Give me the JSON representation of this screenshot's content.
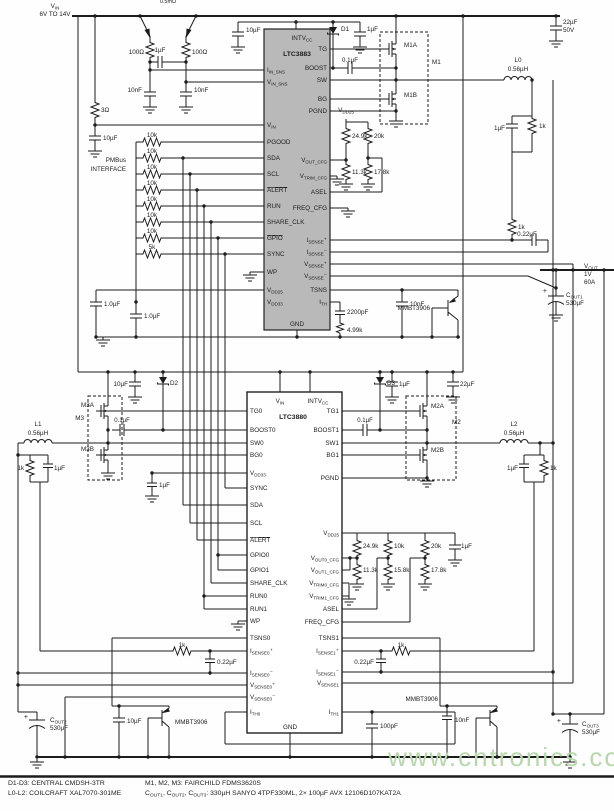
{
  "watermark": "www.cntronics.com",
  "colors": {
    "wire": "#1c1c1c",
    "ic_fill": "#b9b9b9",
    "ic_stroke": "#222222",
    "watermark": "#b7d8ab",
    "background": "#fefefe"
  },
  "labels": [
    {
      "t": "V~IN~",
      "x": 55,
      "y": 8,
      "a": "m",
      "n": "net-vin"
    },
    {
      "t": "6V TO 14V",
      "x": 55,
      "y": 16,
      "a": "m"
    },
    {
      "t": "0.5mΩ",
      "x": 168,
      "y": 3,
      "a": "m",
      "s": 5.5
    },
    {
      "t": "100Ω",
      "x": 144,
      "y": 54,
      "a": "e"
    },
    {
      "t": "100Ω",
      "x": 192,
      "y": 54
    },
    {
      "t": "1µF",
      "x": 160,
      "y": 52,
      "a": "m"
    },
    {
      "t": "10nF",
      "x": 142,
      "y": 92,
      "a": "e"
    },
    {
      "t": "10nF",
      "x": 194,
      "y": 92
    },
    {
      "t": "3Ω",
      "x": 101,
      "y": 112
    },
    {
      "t": "10µF",
      "x": 103,
      "y": 140
    },
    {
      "t": "10µF",
      "x": 246,
      "y": 32
    },
    {
      "t": "D1",
      "x": 341,
      "y": 31
    },
    {
      "t": "1µF",
      "x": 367,
      "y": 31
    },
    {
      "t": "22µF",
      "x": 563,
      "y": 24
    },
    {
      "t": "50V",
      "x": 563,
      "y": 32
    },
    {
      "t": "0.1µF",
      "x": 350,
      "y": 62,
      "a": "m"
    },
    {
      "t": "M1A",
      "x": 404,
      "y": 47
    },
    {
      "t": "M1B",
      "x": 404,
      "y": 97
    },
    {
      "t": "M1",
      "x": 432,
      "y": 64
    },
    {
      "t": "L0",
      "x": 518,
      "y": 62,
      "a": "m"
    },
    {
      "t": "0.56µH",
      "x": 518,
      "y": 71,
      "a": "m"
    },
    {
      "t": "1µF",
      "x": 505,
      "y": 130,
      "a": "e"
    },
    {
      "t": "1k",
      "x": 539,
      "y": 128
    },
    {
      "t": "1k",
      "x": 518,
      "y": 229
    },
    {
      "t": "0.22µF",
      "x": 527,
      "y": 236,
      "a": "m"
    },
    {
      "t": "V~OUT~",
      "x": 584,
      "y": 268,
      "n": "net-vout"
    },
    {
      "t": "1V",
      "x": 584,
      "y": 276
    },
    {
      "t": "60A",
      "x": 584,
      "y": 284
    },
    {
      "t": "+",
      "x": 547,
      "y": 293,
      "a": "e",
      "s": 7
    },
    {
      "t": "C~OUT1~",
      "x": 566,
      "y": 297
    },
    {
      "t": "530µF",
      "x": 566,
      "y": 305
    },
    {
      "t": "V~DD25~",
      "x": 346,
      "y": 112,
      "a": "m"
    },
    {
      "t": "24.9k",
      "x": 352,
      "y": 138
    },
    {
      "t": "20k",
      "x": 374,
      "y": 138
    },
    {
      "t": "11.3k",
      "x": 352,
      "y": 174
    },
    {
      "t": "17.8k",
      "x": 374,
      "y": 174
    },
    {
      "t": "PMBus",
      "x": 126,
      "y": 162,
      "a": "e"
    },
    {
      "t": "INTERFACE",
      "x": 126,
      "y": 171,
      "a": "e"
    },
    {
      "t": "10k",
      "x": 152,
      "y": 137,
      "a": "m"
    },
    {
      "t": "10k",
      "x": 152,
      "y": 153,
      "a": "m"
    },
    {
      "t": "10k",
      "x": 152,
      "y": 169,
      "a": "m"
    },
    {
      "t": "10k",
      "x": 152,
      "y": 185,
      "a": "m"
    },
    {
      "t": "10k",
      "x": 152,
      "y": 201,
      "a": "m"
    },
    {
      "t": "10k",
      "x": 152,
      "y": 217,
      "a": "m"
    },
    {
      "t": "10k",
      "x": 152,
      "y": 233,
      "a": "m"
    },
    {
      "t": "5k",
      "x": 152,
      "y": 249,
      "a": "m"
    },
    {
      "t": "1.0µF",
      "x": 104,
      "y": 306
    },
    {
      "t": "1.0µF",
      "x": 144,
      "y": 318
    },
    {
      "t": "2200pF",
      "x": 347,
      "y": 314
    },
    {
      "t": "4.99k",
      "x": 347,
      "y": 332
    },
    {
      "t": "10nF",
      "x": 410,
      "y": 306
    },
    {
      "t": "MMBT3906",
      "x": 430,
      "y": 310,
      "a": "e"
    },
    {
      "t": "I~IN_SNS~",
      "x": 267,
      "y": 72
    },
    {
      "t": "V~IN_SNS~",
      "x": 267,
      "y": 84
    },
    {
      "t": "V~IN~",
      "x": 267,
      "y": 127
    },
    {
      "t": "PGOOD",
      "x": 267,
      "y": 144
    },
    {
      "t": "SDA",
      "x": 267,
      "y": 160
    },
    {
      "t": "SCL",
      "x": 267,
      "y": 176
    },
    {
      "t": "ALERT",
      "x": 267,
      "y": 192,
      "o": 1
    },
    {
      "t": "RUN",
      "x": 267,
      "y": 208
    },
    {
      "t": "SHARE_CLK",
      "x": 267,
      "y": 224
    },
    {
      "t": "GPIO",
      "x": 267,
      "y": 240,
      "o": 1
    },
    {
      "t": "SYNC",
      "x": 267,
      "y": 256
    },
    {
      "t": "WP",
      "x": 267,
      "y": 274
    },
    {
      "t": "V~DD25~",
      "x": 267,
      "y": 292
    },
    {
      "t": "V~DD33~",
      "x": 267,
      "y": 304
    },
    {
      "t": "GND",
      "x": 297,
      "y": 326,
      "a": "m"
    },
    {
      "t": "INTV~CC~",
      "x": 302,
      "y": 40,
      "a": "m"
    },
    {
      "t": "LTC3883",
      "x": 297,
      "y": 56,
      "a": "m",
      "b": 1,
      "s": 6.8,
      "n": "ic-name"
    },
    {
      "t": "TG",
      "x": 327,
      "y": 51,
      "a": "e"
    },
    {
      "t": "BOOST",
      "x": 327,
      "y": 70,
      "a": "e"
    },
    {
      "t": "SW",
      "x": 327,
      "y": 82,
      "a": "e"
    },
    {
      "t": "BG",
      "x": 327,
      "y": 101,
      "a": "e"
    },
    {
      "t": "PGND",
      "x": 327,
      "y": 113,
      "a": "e"
    },
    {
      "t": "V~OUT_CFG~",
      "x": 327,
      "y": 162,
      "a": "e"
    },
    {
      "t": "V~TRIM_CFG~",
      "x": 327,
      "y": 178,
      "a": "e"
    },
    {
      "t": "ASEL",
      "x": 327,
      "y": 194,
      "a": "e"
    },
    {
      "t": "FREQ_CFG",
      "x": 327,
      "y": 210,
      "a": "e"
    },
    {
      "t": "I~SENSE~⁺",
      "x": 327,
      "y": 242,
      "a": "e"
    },
    {
      "t": "I~SENSE~⁻",
      "x": 327,
      "y": 254,
      "a": "e"
    },
    {
      "t": "V~SENSE~⁺",
      "x": 327,
      "y": 266,
      "a": "e"
    },
    {
      "t": "V~SENSE~⁻",
      "x": 327,
      "y": 278,
      "a": "e"
    },
    {
      "t": "TSNS",
      "x": 327,
      "y": 292,
      "a": "e"
    },
    {
      "t": "I~TH~",
      "x": 327,
      "y": 304,
      "a": "e"
    },
    {
      "t": "10µF",
      "x": 128,
      "y": 386,
      "a": "e"
    },
    {
      "t": "D2",
      "x": 170,
      "y": 385
    },
    {
      "t": "D3",
      "x": 387,
      "y": 385
    },
    {
      "t": "1µF",
      "x": 399,
      "y": 386
    },
    {
      "t": "22µF",
      "x": 460,
      "y": 386
    },
    {
      "t": "M3A",
      "x": 94,
      "y": 407,
      "a": "e"
    },
    {
      "t": "M3B",
      "x": 94,
      "y": 451,
      "a": "e"
    },
    {
      "t": "M3",
      "x": 84,
      "y": 420,
      "a": "e"
    },
    {
      "t": "L1",
      "x": 38,
      "y": 426,
      "a": "m"
    },
    {
      "t": "0.56µH",
      "x": 38,
      "y": 435,
      "a": "m"
    },
    {
      "t": "0.1µF",
      "x": 122,
      "y": 422,
      "a": "m",
      "s": 6
    },
    {
      "t": "0.1µF",
      "x": 365,
      "y": 422,
      "a": "m",
      "s": 6
    },
    {
      "t": "M2A",
      "x": 431,
      "y": 408
    },
    {
      "t": "M2B",
      "x": 431,
      "y": 452
    },
    {
      "t": "M2",
      "x": 452,
      "y": 424
    },
    {
      "t": "L2",
      "x": 514,
      "y": 426,
      "a": "m"
    },
    {
      "t": "0.56µH",
      "x": 514,
      "y": 435,
      "a": "m"
    },
    {
      "t": "1k",
      "x": 24,
      "y": 470,
      "a": "e"
    },
    {
      "t": "1µF",
      "x": 54,
      "y": 470
    },
    {
      "t": "1k",
      "x": 550,
      "y": 470
    },
    {
      "t": "1µF",
      "x": 518,
      "y": 470,
      "a": "e"
    },
    {
      "t": "1µF",
      "x": 159,
      "y": 487
    },
    {
      "t": "24.9k",
      "x": 363,
      "y": 548
    },
    {
      "t": "10k",
      "x": 394,
      "y": 548
    },
    {
      "t": "20k",
      "x": 431,
      "y": 548
    },
    {
      "t": "1µF",
      "x": 461,
      "y": 548
    },
    {
      "t": "11.3k",
      "x": 363,
      "y": 572
    },
    {
      "t": "15.8k",
      "x": 394,
      "y": 572
    },
    {
      "t": "17.8k",
      "x": 431,
      "y": 572
    },
    {
      "t": "1k",
      "x": 182,
      "y": 647,
      "a": "m"
    },
    {
      "t": "0.22µF",
      "x": 217,
      "y": 664
    },
    {
      "t": "1k",
      "x": 401,
      "y": 647,
      "a": "m"
    },
    {
      "t": "0.22µF",
      "x": 374,
      "y": 664,
      "a": "e"
    },
    {
      "t": "100pF",
      "x": 380,
      "y": 728
    },
    {
      "t": "10µF",
      "x": 127,
      "y": 723
    },
    {
      "t": "MMBT3906",
      "x": 175,
      "y": 724
    },
    {
      "t": "10nF",
      "x": 455,
      "y": 722
    },
    {
      "t": "MMBT3906",
      "x": 438,
      "y": 701,
      "a": "e"
    },
    {
      "t": "+",
      "x": 28,
      "y": 719,
      "a": "e",
      "s": 7
    },
    {
      "t": "C~OUT2~",
      "x": 50,
      "y": 722
    },
    {
      "t": "530µF",
      "x": 50,
      "y": 730
    },
    {
      "t": "+",
      "x": 561,
      "y": 723,
      "a": "e",
      "s": 7
    },
    {
      "t": "C~OUT3~",
      "x": 582,
      "y": 726
    },
    {
      "t": "530µF",
      "x": 582,
      "y": 734
    },
    {
      "t": "TG0",
      "x": 250,
      "y": 413
    },
    {
      "t": "BOOST0",
      "x": 250,
      "y": 432
    },
    {
      "t": "SW0",
      "x": 250,
      "y": 445
    },
    {
      "t": "BG0",
      "x": 250,
      "y": 457
    },
    {
      "t": "V~DD33~",
      "x": 250,
      "y": 475
    },
    {
      "t": "SYNC",
      "x": 250,
      "y": 490
    },
    {
      "t": "SDA",
      "x": 250,
      "y": 507
    },
    {
      "t": "SCL",
      "x": 250,
      "y": 525
    },
    {
      "t": "ALERT",
      "x": 250,
      "y": 542,
      "o": 1
    },
    {
      "t": "GPIO0",
      "x": 250,
      "y": 557
    },
    {
      "t": "GPIO1",
      "x": 250,
      "y": 572
    },
    {
      "t": "SHARE_CLK",
      "x": 250,
      "y": 585
    },
    {
      "t": "RUN0",
      "x": 250,
      "y": 598
    },
    {
      "t": "RUN1",
      "x": 250,
      "y": 611
    },
    {
      "t": "WP",
      "x": 250,
      "y": 623
    },
    {
      "t": "TSNS0",
      "x": 250,
      "y": 640
    },
    {
      "t": "I~SENSE0~⁺",
      "x": 250,
      "y": 653
    },
    {
      "t": "I~SENSE0~⁻",
      "x": 250,
      "y": 675
    },
    {
      "t": "V~SENSE0~⁺",
      "x": 250,
      "y": 687
    },
    {
      "t": "V~SENSE0~⁻",
      "x": 250,
      "y": 699
    },
    {
      "t": "I~TH0~",
      "x": 250,
      "y": 714
    },
    {
      "t": "TG1",
      "x": 339,
      "y": 413,
      "a": "e"
    },
    {
      "t": "BOOST1",
      "x": 339,
      "y": 432,
      "a": "e"
    },
    {
      "t": "SW1",
      "x": 339,
      "y": 445,
      "a": "e"
    },
    {
      "t": "BG1",
      "x": 339,
      "y": 457,
      "a": "e"
    },
    {
      "t": "PGND",
      "x": 339,
      "y": 480,
      "a": "e"
    },
    {
      "t": "V~DD25~",
      "x": 339,
      "y": 535,
      "a": "e"
    },
    {
      "t": "V~OUT0_CFG~",
      "x": 339,
      "y": 560,
      "a": "e"
    },
    {
      "t": "V~OUT1_CFG~",
      "x": 339,
      "y": 572,
      "a": "e"
    },
    {
      "t": "V~TRIM0_CFG~",
      "x": 339,
      "y": 585,
      "a": "e"
    },
    {
      "t": "V~TRIM1_CFG~",
      "x": 339,
      "y": 598,
      "a": "e"
    },
    {
      "t": "ASEL",
      "x": 339,
      "y": 611,
      "a": "e"
    },
    {
      "t": "FREQ_CFG",
      "x": 339,
      "y": 624,
      "a": "e"
    },
    {
      "t": "TSNS1",
      "x": 339,
      "y": 640,
      "a": "e"
    },
    {
      "t": "I~SENSE1~⁺",
      "x": 339,
      "y": 653,
      "a": "e"
    },
    {
      "t": "I~SENSE1~⁻",
      "x": 339,
      "y": 674,
      "a": "e"
    },
    {
      "t": "V~SENSE1~",
      "x": 339,
      "y": 685,
      "a": "e"
    },
    {
      "t": "I~TH1~",
      "x": 339,
      "y": 714,
      "a": "e"
    },
    {
      "t": "V~IN~",
      "x": 280,
      "y": 403,
      "a": "m"
    },
    {
      "t": "INTV~CC~",
      "x": 318,
      "y": 403,
      "a": "m"
    },
    {
      "t": "LTC3880",
      "x": 293,
      "y": 419,
      "a": "m",
      "b": 1,
      "s": 6.8,
      "n": "ic-name"
    },
    {
      "t": "GND",
      "x": 290,
      "y": 729,
      "a": "m"
    },
    {
      "t": "D1-D3: CENTRAL CMDSH-3TR",
      "x": 8,
      "y": 785,
      "s": 6.8,
      "n": "note"
    },
    {
      "t": "L0-L2: COILCRAFT XAL7070-301ME",
      "x": 8,
      "y": 795,
      "s": 6.8,
      "n": "note"
    },
    {
      "t": "M1, M2, M3: FAIRCHILD FDMS3620S",
      "x": 145,
      "y": 785,
      "s": 6.8,
      "n": "note"
    },
    {
      "t": "C~OUT1~, C~OUT2~, C~OUT3~: 330µH SANYO 4TPF330ML, 2× 100µF AVX 12106D107KAT2A",
      "x": 145,
      "y": 795,
      "s": 6.8,
      "n": "note"
    }
  ]
}
